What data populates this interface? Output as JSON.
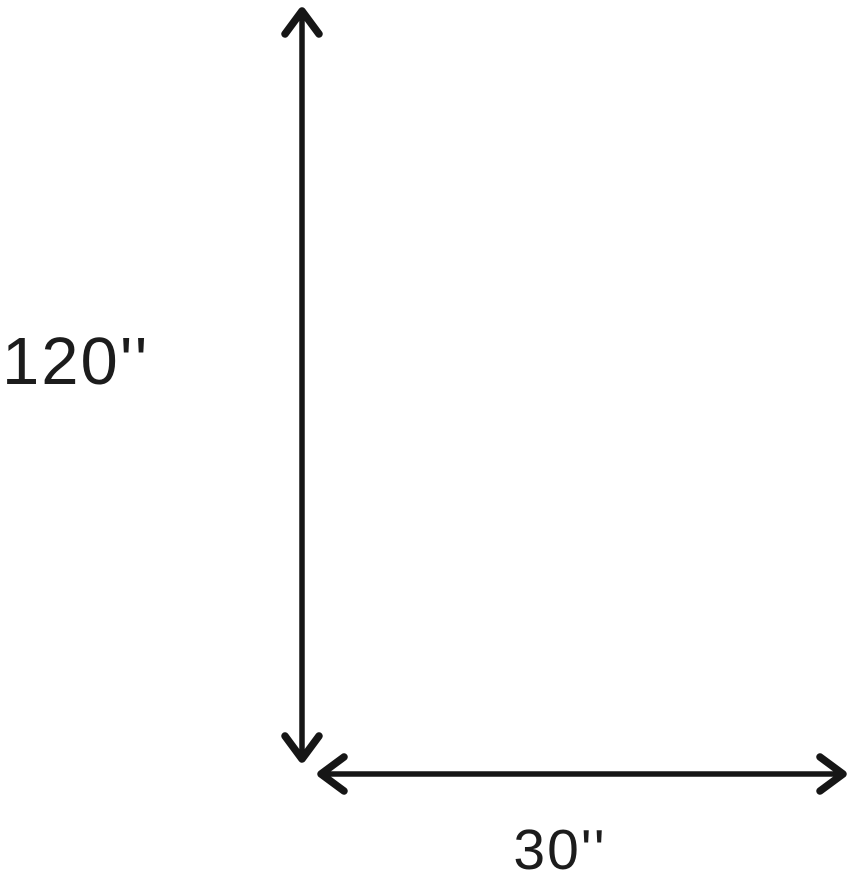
{
  "diagram": {
    "height_label": "120''",
    "width_label": "30''",
    "arrow_color": "#161616",
    "label_color": "#1c1c1c",
    "background_color": "#ffffff"
  },
  "rug": {
    "alt": "Distressed vintage oriental area rug, ivory and beige with faded multicolor floral motifs",
    "palette": {
      "base": "#d7ccbb",
      "light_patch": "#efe8da",
      "dark_patch": "#b9a68c",
      "border_band": "#b19d82",
      "border_line": "#9a8468",
      "border_motif": "#8f7a60",
      "bottom_band": "#a68d6b",
      "bottom_dash": "#7d6750",
      "edge_band": "#d5d0c6",
      "edge_line": "#a9a396",
      "fringe_light": "#d8d2c4",
      "fringe_dark": "#bfb8a8",
      "stem": "#9a8872",
      "motif_center": "#6f6154",
      "striae_tint": "#ede7da",
      "mottle_tint": "#9e8a6b",
      "motif_colors": [
        "#a8927a",
        "#9a8878",
        "#8f8292",
        "#ad9166",
        "#96a0ae",
        "#a1806a",
        "#b49a72"
      ]
    },
    "features": [
      {
        "type": "wreath",
        "x": 102,
        "y": 63,
        "r": 30,
        "color": "#d99b2f",
        "color2": "#c07d22",
        "center": "#9b8d92"
      },
      {
        "type": "rosette",
        "x": 100,
        "y": 113,
        "r": 13,
        "color": "#6b7894",
        "opacity": 0.8
      },
      {
        "type": "rosette",
        "x": 213,
        "y": 148,
        "r": 10,
        "color": "#7d88a2",
        "opacity": 0.5
      },
      {
        "type": "wreath",
        "x": 316,
        "y": 256,
        "r": 20,
        "color": "#bf5230",
        "color2": "#a63e1f",
        "center": "#c4b9a8"
      },
      {
        "type": "rosette",
        "x": 418,
        "y": 347,
        "r": 16,
        "color": "#bd5540",
        "opacity": 0.85
      },
      {
        "type": "blob",
        "x": 203,
        "y": 452,
        "rx": 30,
        "ry": 22,
        "color": "#d9a33c",
        "color2": "#c8922f",
        "opacity": 0.7
      },
      {
        "type": "rosette",
        "x": 243,
        "y": 450,
        "r": 8,
        "color": "#5d6880",
        "opacity": 0.7
      },
      {
        "type": "dot",
        "x": 60,
        "y": 290,
        "r": 5,
        "color": "#b3543c"
      },
      {
        "type": "dot",
        "x": 165,
        "y": 598,
        "r": 5,
        "color": "#ab4f38"
      },
      {
        "type": "dot",
        "x": 418,
        "y": 628,
        "r": 4,
        "color": "#b3543c"
      },
      {
        "type": "dot",
        "x": 345,
        "y": 95,
        "r": 6,
        "color": "#c08030"
      },
      {
        "type": "dot",
        "x": 455,
        "y": 210,
        "r": 5,
        "color": "#bd8e4f"
      },
      {
        "type": "dot",
        "x": 60,
        "y": 650,
        "r": 5,
        "color": "#c08a3a"
      },
      {
        "type": "dot",
        "x": 480,
        "y": 560,
        "r": 4,
        "color": "#b3543c"
      }
    ]
  }
}
